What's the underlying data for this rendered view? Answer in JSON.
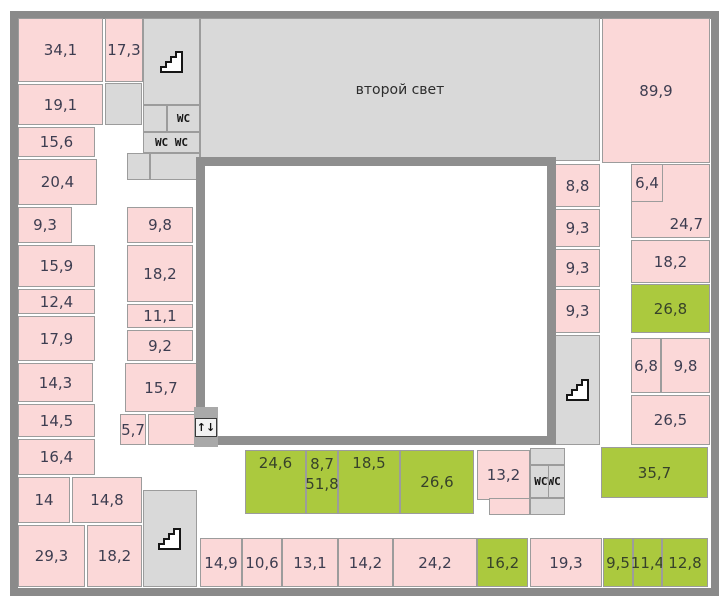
{
  "floorplan": {
    "colors": {
      "room_pink": "#fbd8d8",
      "room_green": "#abc93e",
      "room_gray": "#d9d9d9",
      "wall_thick": "#8a8a8a",
      "void_border": "#8f8f8f",
      "room_border": "#9c9c9c",
      "label_text": "#3d3d50"
    },
    "rooms": [
      {
        "name": "second-light",
        "label": "второй свет",
        "type": "gray",
        "x": 200,
        "y": 18,
        "w": 400,
        "h": 143
      },
      {
        "name": "stairwell-top",
        "label": "",
        "type": "gray",
        "x": 143,
        "y": 18,
        "w": 57,
        "h": 87,
        "icon": "stairs"
      },
      {
        "name": "wc-ante-top",
        "label": "",
        "type": "gray",
        "x": 143,
        "y": 105,
        "w": 24,
        "h": 27
      },
      {
        "name": "wc-top",
        "label": "WC",
        "type": "gray",
        "x": 167,
        "y": 105,
        "w": 33,
        "h": 27,
        "mono": true
      },
      {
        "name": "wc-double-top",
        "label": "WC WC",
        "type": "gray",
        "x": 143,
        "y": 132,
        "w": 57,
        "h": 21,
        "mono": true
      },
      {
        "name": "gray-cell-a",
        "label": "",
        "type": "gray",
        "x": 127,
        "y": 153,
        "w": 23,
        "h": 27
      },
      {
        "name": "gray-cell-b",
        "label": "",
        "type": "gray",
        "x": 150,
        "y": 153,
        "w": 50,
        "h": 27
      },
      {
        "name": "gray-cell-c",
        "label": "",
        "type": "gray",
        "x": 105,
        "y": 83,
        "w": 37,
        "h": 42
      },
      {
        "name": "stairwell-right",
        "label": "",
        "type": "gray",
        "x": 555,
        "y": 335,
        "w": 45,
        "h": 110,
        "icon": "stairs"
      },
      {
        "name": "stairwell-bottom",
        "label": "",
        "type": "gray",
        "x": 143,
        "y": 490,
        "w": 54,
        "h": 97,
        "icon": "stairs"
      },
      {
        "name": "wc-br-ante-top",
        "label": "",
        "type": "gray",
        "x": 530,
        "y": 448,
        "w": 35,
        "h": 17
      },
      {
        "name": "wc-br",
        "label": "WCWC",
        "type": "gray",
        "x": 530,
        "y": 465,
        "w": 35,
        "h": 33,
        "mono": true,
        "divider": true
      },
      {
        "name": "wc-br-ante-bottom",
        "label": "",
        "type": "gray",
        "x": 530,
        "y": 498,
        "w": 35,
        "h": 17
      },
      {
        "name": "room-34-1",
        "label": "34,1",
        "type": "pink",
        "x": 18,
        "y": 18,
        "w": 85,
        "h": 64
      },
      {
        "name": "room-17-3",
        "label": "17,3",
        "type": "pink",
        "x": 105,
        "y": 18,
        "w": 38,
        "h": 64
      },
      {
        "name": "room-19-1",
        "label": "19,1",
        "type": "pink",
        "x": 18,
        "y": 84,
        "w": 85,
        "h": 41
      },
      {
        "name": "room-15-6",
        "label": "15,6",
        "type": "pink",
        "x": 18,
        "y": 127,
        "w": 77,
        "h": 30
      },
      {
        "name": "room-20-4",
        "label": "20,4",
        "type": "pink",
        "x": 18,
        "y": 159,
        "w": 79,
        "h": 46
      },
      {
        "name": "room-9-3-left",
        "label": "9,3",
        "type": "pink",
        "x": 18,
        "y": 207,
        "w": 54,
        "h": 36
      },
      {
        "name": "room-15-9",
        "label": "15,9",
        "type": "pink",
        "x": 18,
        "y": 245,
        "w": 77,
        "h": 42
      },
      {
        "name": "room-12-4",
        "label": "12,4",
        "type": "pink",
        "x": 18,
        "y": 289,
        "w": 77,
        "h": 25
      },
      {
        "name": "room-17-9",
        "label": "17,9",
        "type": "pink",
        "x": 18,
        "y": 316,
        "w": 77,
        "h": 45
      },
      {
        "name": "room-14-3",
        "label": "14,3",
        "type": "pink",
        "x": 18,
        "y": 363,
        "w": 75,
        "h": 39
      },
      {
        "name": "room-14-5",
        "label": "14,5",
        "type": "pink",
        "x": 18,
        "y": 404,
        "w": 77,
        "h": 33
      },
      {
        "name": "room-16-4",
        "label": "16,4",
        "type": "pink",
        "x": 18,
        "y": 439,
        "w": 77,
        "h": 36
      },
      {
        "name": "room-14",
        "label": "14",
        "type": "pink",
        "x": 18,
        "y": 477,
        "w": 52,
        "h": 46
      },
      {
        "name": "room-14-8",
        "label": "14,8",
        "type": "pink",
        "x": 72,
        "y": 477,
        "w": 70,
        "h": 46
      },
      {
        "name": "room-29-3",
        "label": "29,3",
        "type": "pink",
        "x": 18,
        "y": 525,
        "w": 67,
        "h": 62
      },
      {
        "name": "room-18-2-bl",
        "label": "18,2",
        "type": "pink",
        "x": 87,
        "y": 525,
        "w": 55,
        "h": 62
      },
      {
        "name": "room-9-8-mid",
        "label": "9,8",
        "type": "pink",
        "x": 127,
        "y": 207,
        "w": 66,
        "h": 36
      },
      {
        "name": "room-18-2-mid",
        "label": "18,2",
        "type": "pink",
        "x": 127,
        "y": 245,
        "w": 66,
        "h": 57
      },
      {
        "name": "room-11-1",
        "label": "11,1",
        "type": "pink",
        "x": 127,
        "y": 304,
        "w": 66,
        "h": 24
      },
      {
        "name": "room-9-2",
        "label": "9,2",
        "type": "pink",
        "x": 127,
        "y": 330,
        "w": 66,
        "h": 31
      },
      {
        "name": "room-15-7",
        "label": "15,7",
        "type": "pink",
        "x": 125,
        "y": 363,
        "w": 72,
        "h": 49
      },
      {
        "name": "room-5-7",
        "label": "5,7",
        "type": "pink",
        "x": 120,
        "y": 414,
        "w": 26,
        "h": 31
      },
      {
        "name": "room-unlabeled",
        "label": "",
        "type": "pink",
        "x": 148,
        "y": 414,
        "w": 48,
        "h": 31
      },
      {
        "name": "room-89-9",
        "label": "89,9",
        "type": "pink",
        "x": 602,
        "y": 18,
        "w": 108,
        "h": 145
      },
      {
        "name": "room-8-8",
        "label": "8,8",
        "type": "pink",
        "x": 555,
        "y": 164,
        "w": 45,
        "h": 43
      },
      {
        "name": "room-9-3-r1",
        "label": "9,3",
        "type": "pink",
        "x": 555,
        "y": 209,
        "w": 45,
        "h": 38
      },
      {
        "name": "room-9-3-r2",
        "label": "9,3",
        "type": "pink",
        "x": 555,
        "y": 249,
        "w": 45,
        "h": 38
      },
      {
        "name": "room-9-3-r3",
        "label": "9,3",
        "type": "pink",
        "x": 555,
        "y": 289,
        "w": 45,
        "h": 44
      },
      {
        "name": "room-24-7",
        "label": "24,7",
        "type": "pink",
        "x": 631,
        "y": 164,
        "w": 79,
        "h": 74,
        "align": "br"
      },
      {
        "name": "room-6-4",
        "label": "6,4",
        "type": "pink",
        "x": 631,
        "y": 164,
        "w": 32,
        "h": 38
      },
      {
        "name": "room-18-2-r",
        "label": "18,2",
        "type": "pink",
        "x": 631,
        "y": 240,
        "w": 79,
        "h": 43
      },
      {
        "name": "room-26-8",
        "label": "26,8",
        "type": "green",
        "x": 631,
        "y": 284,
        "w": 79,
        "h": 49
      },
      {
        "name": "room-6-8",
        "label": "6,8",
        "type": "pink",
        "x": 631,
        "y": 338,
        "w": 30,
        "h": 55
      },
      {
        "name": "room-9-8-r",
        "label": "9,8",
        "type": "pink",
        "x": 661,
        "y": 338,
        "w": 49,
        "h": 55
      },
      {
        "name": "room-26-5",
        "label": "26,5",
        "type": "pink",
        "x": 631,
        "y": 395,
        "w": 79,
        "h": 50
      },
      {
        "name": "room-35-7",
        "label": "35,7",
        "type": "green",
        "x": 601,
        "y": 447,
        "w": 107,
        "h": 51
      },
      {
        "name": "room-24-6",
        "label": "24,6",
        "type": "green",
        "x": 245,
        "y": 450,
        "w": 61,
        "h": 64,
        "align": "top"
      },
      {
        "name": "room-8-7-51-8",
        "label": "8,7",
        "label2": "51,8",
        "type": "green",
        "x": 306,
        "y": 450,
        "w": 32,
        "h": 64
      },
      {
        "name": "room-18-5",
        "label": "18,5",
        "type": "green",
        "x": 338,
        "y": 450,
        "w": 62,
        "h": 64,
        "align": "top"
      },
      {
        "name": "room-26-6",
        "label": "26,6",
        "type": "green",
        "x": 400,
        "y": 450,
        "w": 74,
        "h": 64
      },
      {
        "name": "room-13-2",
        "label": "13,2",
        "type": "pink",
        "x": 477,
        "y": 450,
        "w": 53,
        "h": 50
      },
      {
        "name": "room-13-2-ext",
        "label": "",
        "type": "pink",
        "x": 489,
        "y": 498,
        "w": 41,
        "h": 17
      },
      {
        "name": "room-14-9",
        "label": "14,9",
        "type": "pink",
        "x": 200,
        "y": 538,
        "w": 42,
        "h": 49
      },
      {
        "name": "room-10-6",
        "label": "10,6",
        "type": "pink",
        "x": 242,
        "y": 538,
        "w": 40,
        "h": 49
      },
      {
        "name": "room-13-1",
        "label": "13,1",
        "type": "pink",
        "x": 282,
        "y": 538,
        "w": 56,
        "h": 49
      },
      {
        "name": "room-14-2",
        "label": "14,2",
        "type": "pink",
        "x": 338,
        "y": 538,
        "w": 55,
        "h": 49
      },
      {
        "name": "room-24-2",
        "label": "24,2",
        "type": "pink",
        "x": 393,
        "y": 538,
        "w": 84,
        "h": 49
      },
      {
        "name": "room-16-2",
        "label": "16,2",
        "type": "green",
        "x": 477,
        "y": 538,
        "w": 51,
        "h": 49
      },
      {
        "name": "room-19-3",
        "label": "19,3",
        "type": "pink",
        "x": 530,
        "y": 538,
        "w": 72,
        "h": 49
      },
      {
        "name": "room-9-5",
        "label": "9,5",
        "type": "green",
        "x": 603,
        "y": 538,
        "w": 30,
        "h": 49
      },
      {
        "name": "room-11-4",
        "label": "11,4",
        "type": "green",
        "x": 633,
        "y": 538,
        "w": 29,
        "h": 49
      },
      {
        "name": "room-12-8",
        "label": "12,8",
        "type": "green",
        "x": 662,
        "y": 538,
        "w": 46,
        "h": 49
      },
      {
        "name": "elevator",
        "label": "↑↓",
        "type": "gray",
        "x": 194,
        "y": 407,
        "w": 24,
        "h": 40,
        "icon": "elevator"
      }
    ]
  }
}
